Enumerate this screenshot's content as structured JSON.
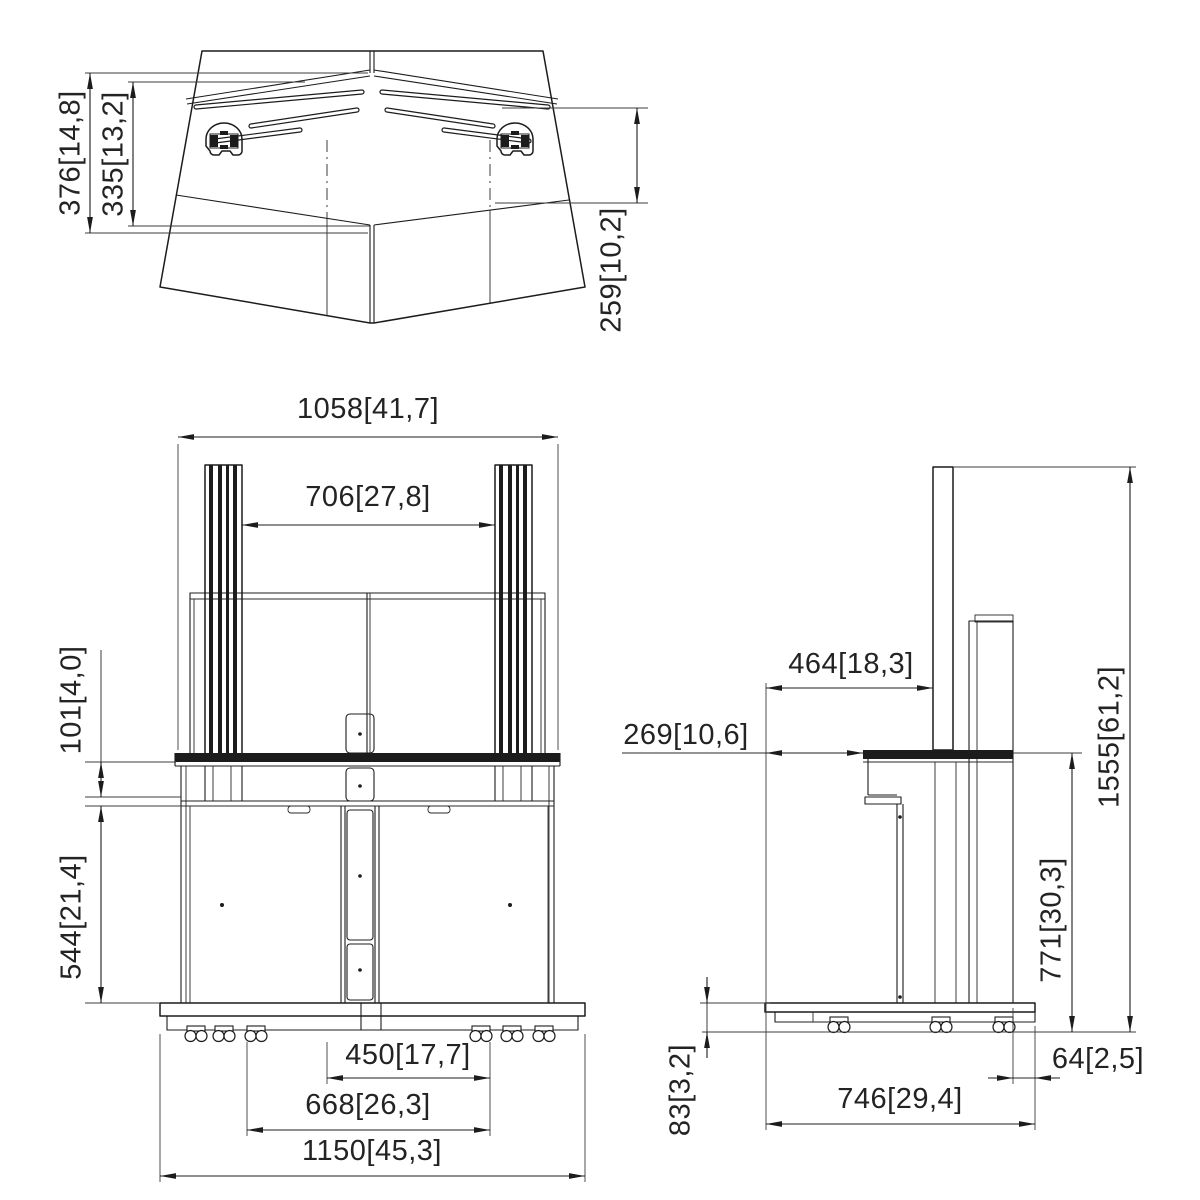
{
  "canvas": {
    "background": "#ffffff",
    "line_color": "#1c1c1c",
    "text_color": "#232323"
  },
  "views": {
    "top": {
      "dims": {
        "d376": {
          "mm": "376",
          "in": "14,8",
          "label": "376[14,8]"
        },
        "d335": {
          "mm": "335",
          "in": "13,2",
          "label": "335[13,2]"
        },
        "d259": {
          "mm": "259",
          "in": "10,2",
          "label": "259[10,2]"
        }
      }
    },
    "front": {
      "dims": {
        "d1058": {
          "mm": "1058",
          "in": "41,7",
          "label": "1058[41,7]"
        },
        "d706": {
          "mm": "706",
          "in": "27,8",
          "label": "706[27,8]"
        },
        "d101": {
          "mm": "101",
          "in": "4,0",
          "label": "101[4,0]"
        },
        "d544": {
          "mm": "544",
          "in": "21,4",
          "label": "544[21,4]"
        },
        "d450": {
          "mm": "450",
          "in": "17,7",
          "label": "450[17,7]"
        },
        "d668": {
          "mm": "668",
          "in": "26,3",
          "label": "668[26,3]"
        },
        "d1150": {
          "mm": "1150",
          "in": "45,3",
          "label": "1150[45,3]"
        }
      }
    },
    "side": {
      "dims": {
        "d464": {
          "mm": "464",
          "in": "18,3",
          "label": "464[18,3]"
        },
        "d269": {
          "mm": "269",
          "in": "10,6",
          "label": "269[10,6]"
        },
        "d1555": {
          "mm": "1555",
          "in": "61,2",
          "label": "1555[61,2]"
        },
        "d771": {
          "mm": "771",
          "in": "30,3",
          "label": "771[30,3]"
        },
        "d83": {
          "mm": "83",
          "in": "3,2",
          "label": "83[3,2]"
        },
        "d746": {
          "mm": "746",
          "in": "29,4",
          "label": "746[29,4]"
        },
        "d64": {
          "mm": "64",
          "in": "2,5",
          "label": "64[2,5]"
        }
      }
    }
  }
}
